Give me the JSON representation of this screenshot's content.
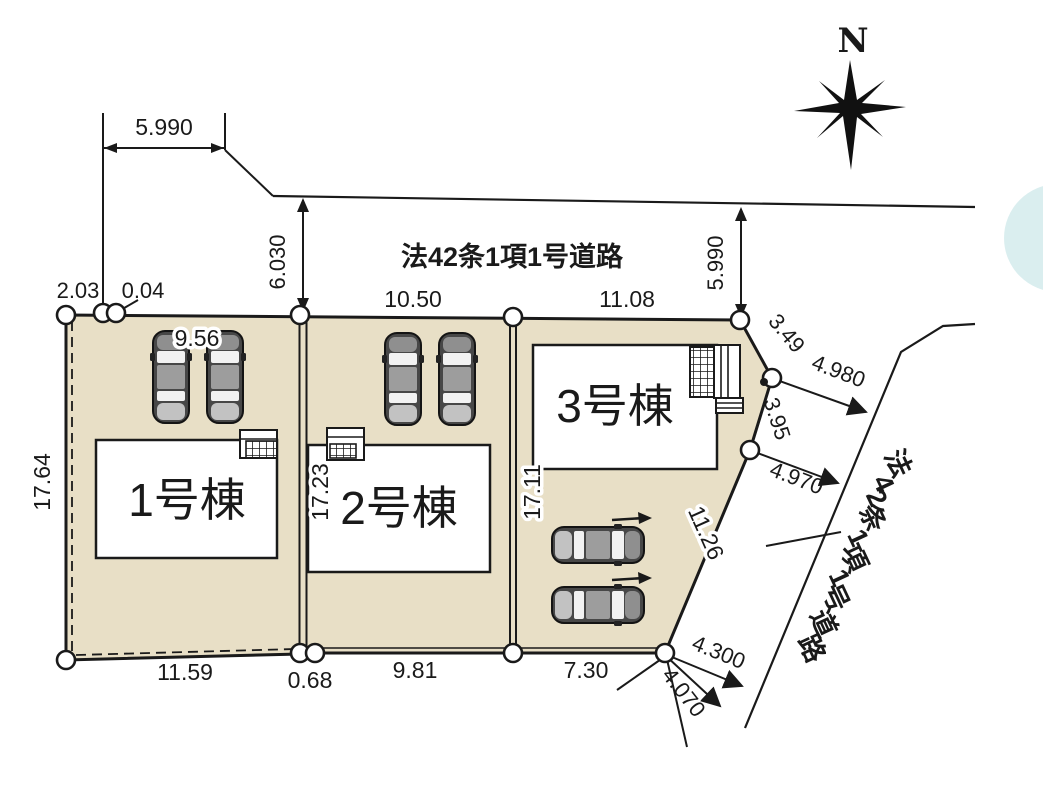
{
  "compass": {
    "label": "N"
  },
  "roads": {
    "top_label": "法42条1項1号道路",
    "right_label": "法42条1項1号道路"
  },
  "buildings": {
    "b1": "1号棟",
    "b2": "2号棟",
    "b3": "3号棟"
  },
  "dims": {
    "top_setback": "5.990",
    "tl_a": "2.03",
    "tl_b": "0.04",
    "road_w_left": "6.030",
    "road_w_right": "5.990",
    "lot1_top": "9.56",
    "lot2_top": "10.50",
    "lot3_top": "11.08",
    "left_side": "17.64",
    "b12_boundary": "17.23",
    "b23_boundary": "17.11",
    "ne_seg1": "3.49",
    "ne_offset1": "4.980",
    "ne_seg2": "3.95",
    "ne_offset2": "4.970",
    "se_edge": "11.26",
    "lot1_bottom": "11.59",
    "bottom_gap": "0.68",
    "lot2_bottom": "9.81",
    "lot3_bottom": "7.30",
    "s_offset1": "4.300",
    "s_offset2": "4.070"
  },
  "colors": {
    "lot_fill": "#e8dfc6",
    "line": "#1a1a1a",
    "water": "#cde8ea"
  }
}
